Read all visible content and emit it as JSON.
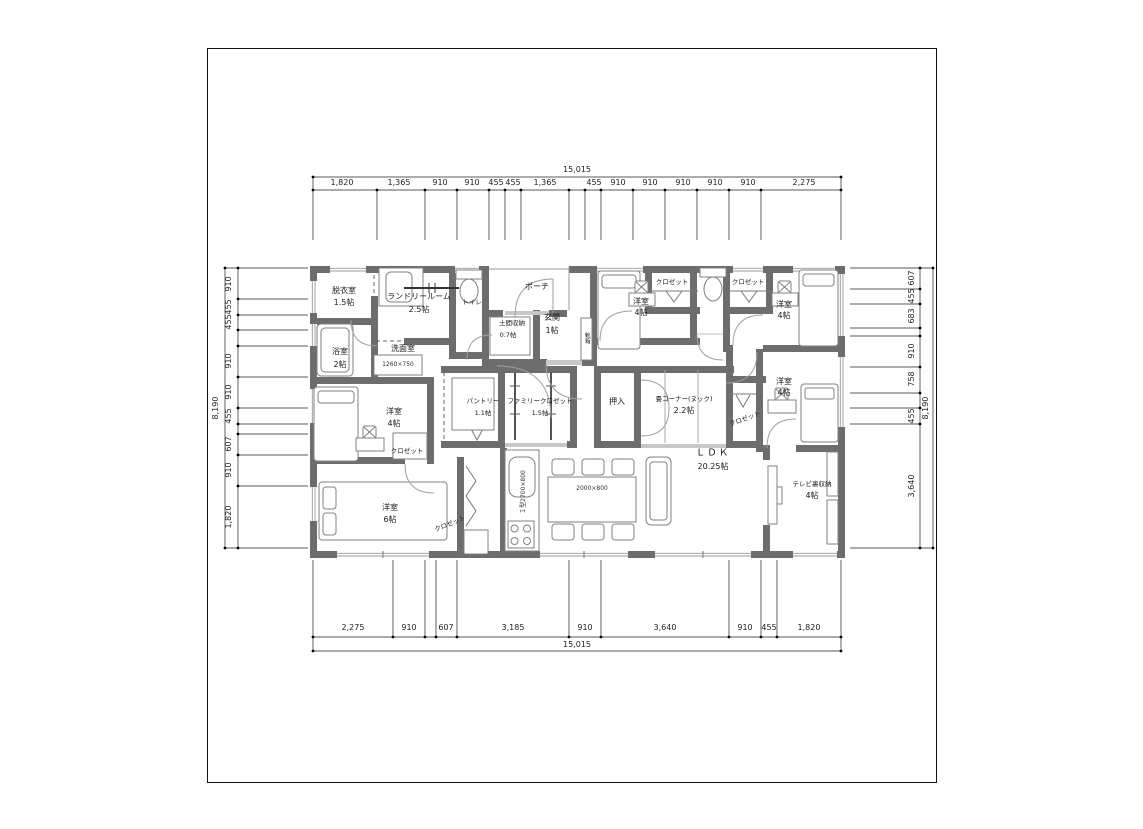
{
  "dims": {
    "top_total": "15,015",
    "bottom_total": "15,015",
    "left_total": "8,190",
    "right_total": "8,190",
    "top": [
      "1,820",
      "1,365",
      "910",
      "910",
      "455",
      "455",
      "1,365",
      "455",
      "910",
      "910",
      "910",
      "910",
      "910",
      "2,275"
    ],
    "bottom": [
      "2,275",
      "910",
      "607",
      "3,185",
      "910",
      "3,640",
      "910",
      "455",
      "1,820"
    ],
    "left": [
      "910",
      "455",
      "455",
      "910",
      "910",
      "455",
      "607",
      "910",
      "1,820"
    ],
    "right": [
      "607",
      "455",
      "683",
      "910",
      "758",
      "455",
      "3,640"
    ]
  },
  "rooms": {
    "datsui": {
      "name": "脱衣室",
      "size": "1.5帖"
    },
    "laundry": {
      "name": "ランドリールーム",
      "size": "2.5帖"
    },
    "toilet": {
      "name": "トイレ"
    },
    "porch": {
      "name": "ポーチ"
    },
    "doma": {
      "name": "土間収納",
      "size": "0.7帖"
    },
    "genkan": {
      "name": "玄関",
      "size": "1帖"
    },
    "shoebox": {
      "name": "靴箱"
    },
    "bath": {
      "name": "浴室",
      "size": "2帖"
    },
    "senmen": {
      "name": "洗面室"
    },
    "bedroom4": {
      "name": "洋室",
      "size": "4帖"
    },
    "bedroom6": {
      "name": "洋室",
      "size": "6帖"
    },
    "closet": {
      "name": "クロゼット"
    },
    "pantry": {
      "name": "パントリー",
      "size": "1.1帖"
    },
    "famiclo": {
      "name": "ファミリークロゼット",
      "size": "1.5帖"
    },
    "oshiire": {
      "name": "押入"
    },
    "tatami": {
      "name": "畳コーナー(ヌック)",
      "size": "2.2帖"
    },
    "ldk": {
      "name": "ＬＤＫ",
      "size": "20.25帖"
    },
    "tv": {
      "name": "テレビ裏収納",
      "size": "4帖"
    }
  },
  "fixtures": {
    "vanity": "1260×750",
    "kitchen": "Ｉ型2700×800",
    "dining_table": "2000×800"
  }
}
